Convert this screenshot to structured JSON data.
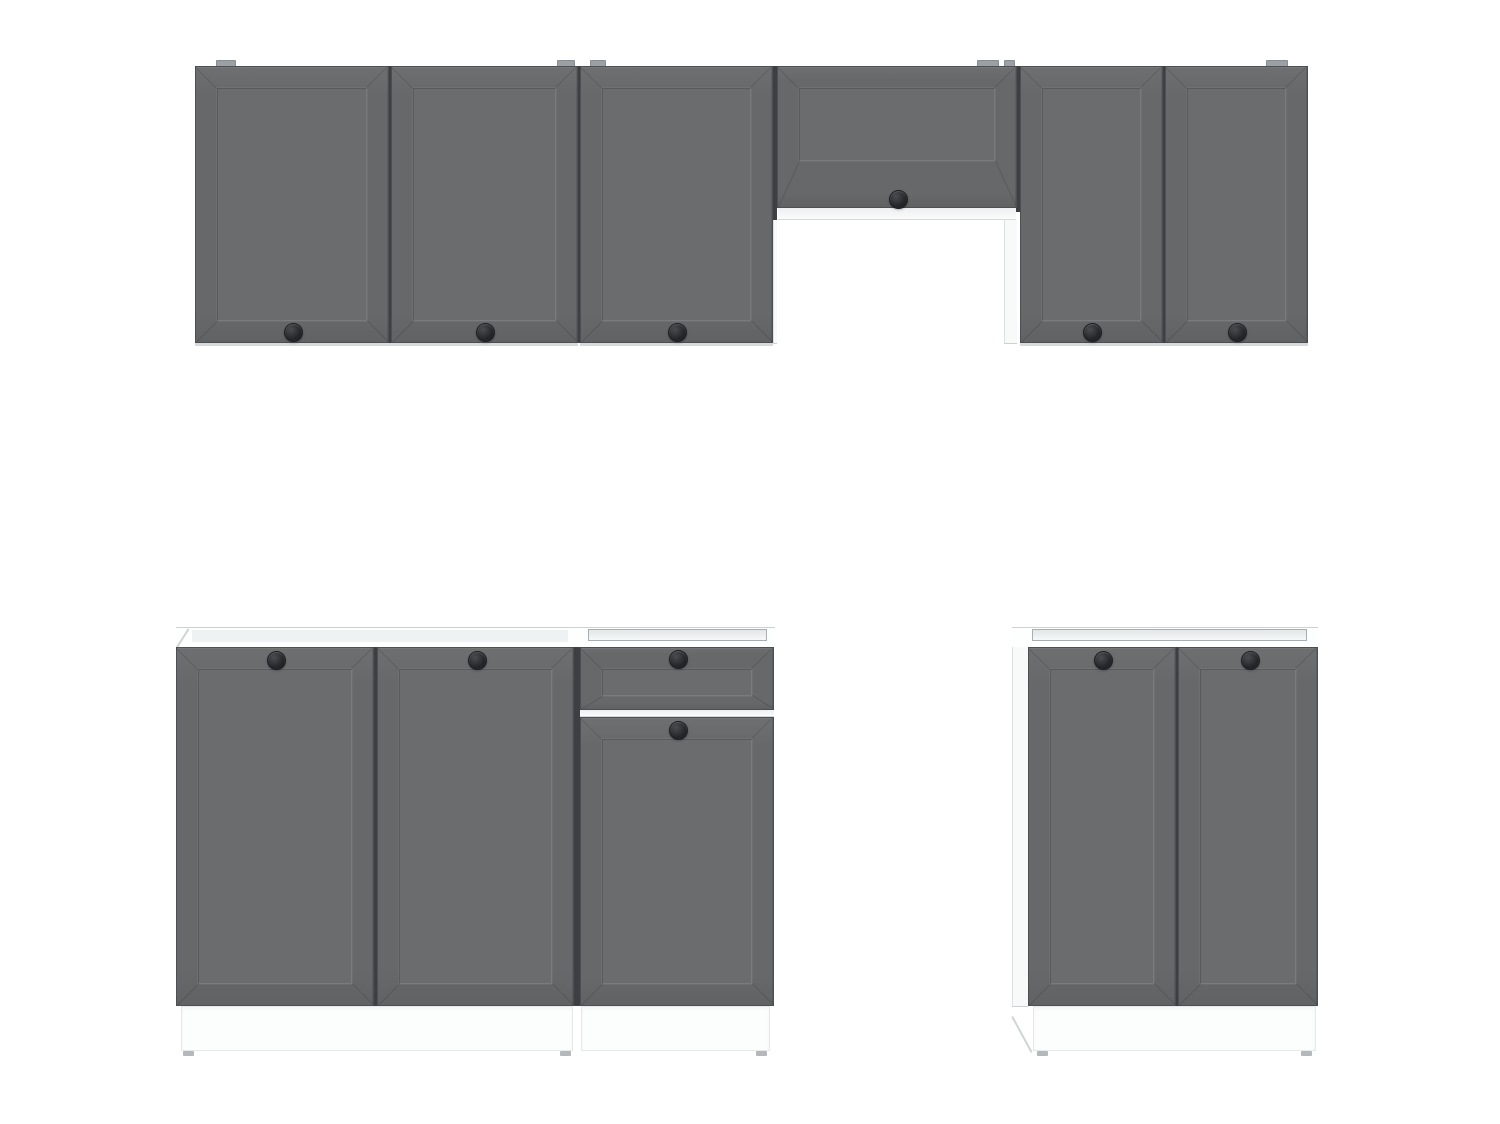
{
  "scene": {
    "width": 1500,
    "height": 1124,
    "background": "#ffffff",
    "description": "Kitchen cabinet set render: wall units (including one short flap unit over a hood gap) and base units with graphite shaker fronts, round black knobs, white carcass and white plinth"
  },
  "colors": {
    "background": "#ffffff",
    "door_face": "#666869",
    "door_hi": "#6d6f71",
    "door_lo": "#606264",
    "door_edge": "#4d4f52",
    "panel_face": "#6a6c6e",
    "miter_line": "rgba(0,0,0,0.13)",
    "knob_dark": "#242528",
    "knob_mid": "#4a4c50",
    "carcass_white": "#fdfefe",
    "gap_shadow": "#3d3f42",
    "hanger_tab": "#9aa0a4",
    "plinth": "#fcfdfd",
    "foot": "#b4b8ba"
  },
  "wall_row": {
    "tabs": [
      {
        "x": 216,
        "w": 20
      },
      {
        "x": 557,
        "w": 18
      },
      {
        "x": 590,
        "w": 16
      },
      {
        "x": 977,
        "w": 22
      },
      {
        "x": 1004,
        "w": 11
      },
      {
        "x": 1266,
        "w": 22
      }
    ],
    "gaps": [
      {
        "x": 388,
        "y": 66,
        "w": 4,
        "h": 277
      },
      {
        "x": 577,
        "y": 66,
        "w": 4,
        "h": 277
      },
      {
        "x": 772,
        "y": 66,
        "w": 5,
        "h": 277
      },
      {
        "x": 1015,
        "y": 66,
        "w": 5,
        "h": 146
      },
      {
        "x": 1162,
        "y": 66,
        "w": 4,
        "h": 277
      }
    ],
    "doors": [
      {
        "name": "wall-door-1",
        "x": 195,
        "y": 66,
        "w": 194,
        "h": 277,
        "knob": [
          97,
          265
        ]
      },
      {
        "name": "wall-door-2",
        "x": 391,
        "y": 66,
        "w": 187,
        "h": 277,
        "knob": [
          93,
          265
        ]
      },
      {
        "name": "wall-door-3",
        "x": 580,
        "y": 66,
        "w": 193,
        "h": 277,
        "knob": [
          96,
          265
        ]
      },
      {
        "name": "flap-door",
        "x": 777,
        "y": 66,
        "w": 240,
        "h": 142,
        "knob": [
          120,
          132
        ],
        "inset": {
          "b": 46
        }
      },
      {
        "name": "wall-door-4",
        "x": 1020,
        "y": 66,
        "w": 143,
        "h": 277,
        "knob": [
          71,
          265
        ]
      },
      {
        "name": "wall-door-5",
        "x": 1165,
        "y": 66,
        "w": 143,
        "h": 277,
        "knob": [
          71,
          265
        ]
      }
    ],
    "shelf": {
      "x": 778,
      "y": 208,
      "w": 238,
      "h": 12
    },
    "side_strips": [
      {
        "x": 773,
        "y": 220,
        "w": 4,
        "h": 124
      },
      {
        "x": 1004,
        "y": 220,
        "w": 13,
        "h": 124
      }
    ],
    "bottom_edges": [
      {
        "x": 195,
        "y": 343,
        "w": 383,
        "h": 3
      },
      {
        "x": 580,
        "y": 343,
        "w": 193,
        "h": 3
      },
      {
        "x": 1020,
        "y": 343,
        "w": 288,
        "h": 3
      }
    ]
  },
  "base_row": {
    "bands": [
      {
        "x": 176,
        "y": 627,
        "w": 599,
        "h": 20
      },
      {
        "x": 1012,
        "y": 627,
        "w": 306,
        "h": 20
      }
    ],
    "band_inner": [
      {
        "x": 192,
        "y": 630,
        "w": 376,
        "h": 12
      }
    ],
    "recesses": [
      {
        "x": 588,
        "y": 629,
        "w": 179,
        "h": 12
      },
      {
        "x": 1032,
        "y": 629,
        "w": 275,
        "h": 12
      }
    ],
    "side_strips": [
      {
        "x": 1012,
        "y": 647,
        "w": 16,
        "h": 360
      }
    ],
    "gaps": [
      {
        "x": 373,
        "y": 647,
        "w": 5,
        "h": 359
      },
      {
        "x": 574,
        "y": 647,
        "w": 6,
        "h": 359
      },
      {
        "x": 1175,
        "y": 647,
        "w": 4,
        "h": 359
      }
    ],
    "doors": [
      {
        "name": "base-door-1",
        "x": 176,
        "y": 647,
        "w": 198,
        "h": 359,
        "knob": [
          99,
          12
        ]
      },
      {
        "name": "base-door-2",
        "x": 377,
        "y": 647,
        "w": 197,
        "h": 359,
        "knob": [
          99,
          12
        ]
      },
      {
        "name": "drawer-front",
        "x": 580,
        "y": 647,
        "w": 194,
        "h": 63,
        "knob": [
          97,
          11
        ],
        "inset": {
          "b": 13
        }
      },
      {
        "name": "base-door-3",
        "x": 580,
        "y": 717,
        "w": 194,
        "h": 289,
        "knob": [
          97,
          12
        ]
      },
      {
        "name": "base-door-4",
        "x": 1028,
        "y": 647,
        "w": 148,
        "h": 359,
        "knob": [
          74,
          12
        ]
      },
      {
        "name": "base-door-5",
        "x": 1178,
        "y": 647,
        "w": 140,
        "h": 359,
        "knob": [
          71,
          12
        ]
      }
    ],
    "drawer_gap": {
      "x": 580,
      "y": 710,
      "w": 194,
      "h": 7
    },
    "plinths": [
      {
        "x": 181,
        "y": 1006,
        "w": 392,
        "h": 45
      },
      {
        "x": 581,
        "y": 1006,
        "w": 189,
        "h": 45
      },
      {
        "x": 1033,
        "y": 1006,
        "w": 283,
        "h": 45
      }
    ],
    "feet": [
      {
        "x": 183
      },
      {
        "x": 560
      },
      {
        "x": 756
      },
      {
        "x": 1037
      },
      {
        "x": 1301
      }
    ],
    "feet_y": 1051,
    "diagonals": [
      {
        "x": 176,
        "y": 647,
        "len": 22,
        "angle": -57.7
      },
      {
        "x": 1013,
        "y": 1016,
        "len": 41,
        "angle": 61.5
      }
    ]
  }
}
